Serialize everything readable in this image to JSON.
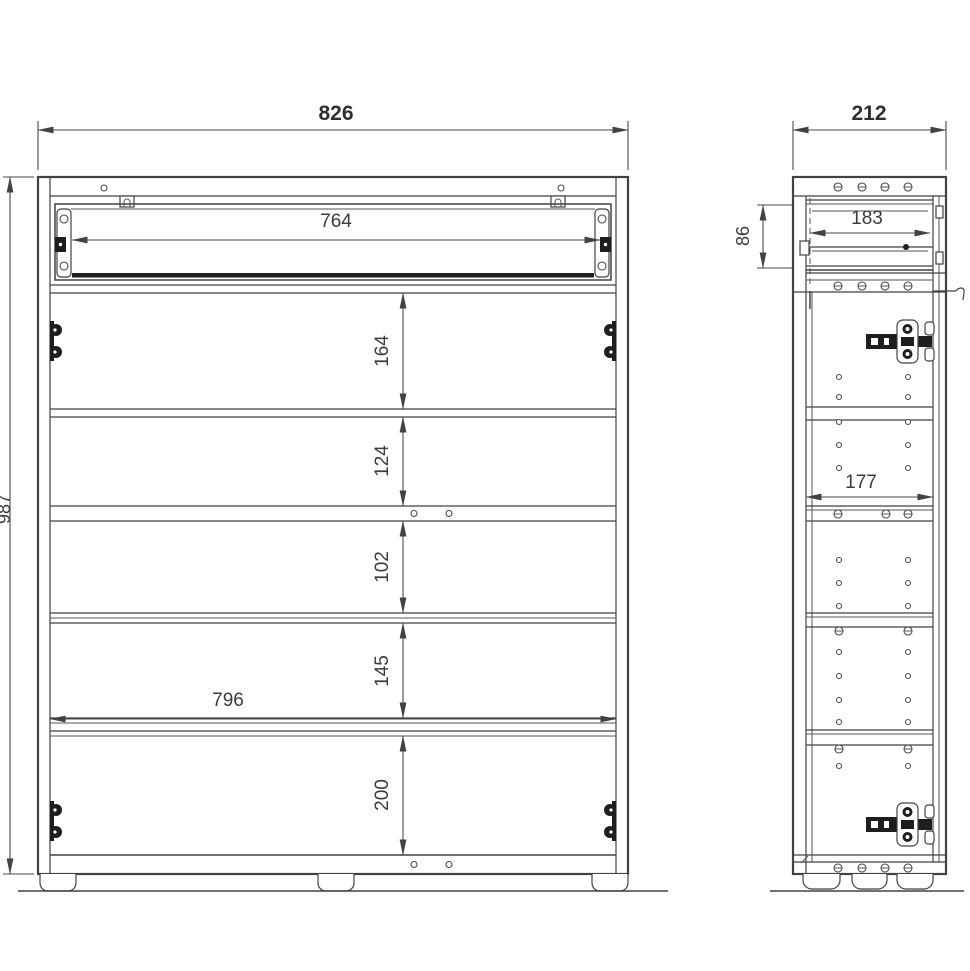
{
  "drawing": {
    "background": "#ffffff",
    "line_color": "#424242",
    "text_color": "#3c3c3c"
  },
  "front_view": {
    "overall_width_mm": "826",
    "overall_height_mm": "987",
    "drawer_clear_width_mm": "764",
    "interior_width_mm": "796",
    "shelf_spacings_mm": [
      "164",
      "124",
      "102",
      "145",
      "200"
    ]
  },
  "side_view": {
    "overall_depth_mm": "212",
    "drawer_clear_depth_mm": "183",
    "drawer_front_height_mm": "86",
    "shelf_depth_mm": "177"
  }
}
